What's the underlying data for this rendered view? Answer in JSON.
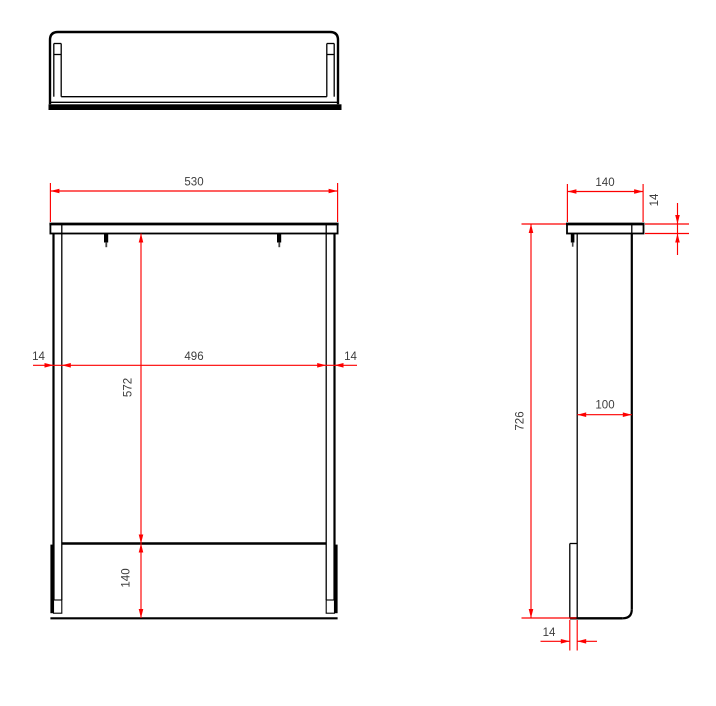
{
  "drawing": {
    "description": "Three-view technical drawing of a shelf unit with dimensions",
    "views": {
      "top": "top view",
      "front": "front view",
      "side": "side view"
    },
    "colors": {
      "outline": "#000000",
      "dimension_line": "#fd0000",
      "dimension_text": "#3d3d3d",
      "background": "#ffffff"
    }
  },
  "dimensions": {
    "front": {
      "overall_width": "530",
      "inner_width": "496",
      "left_panel_thickness": "14",
      "right_panel_thickness": "14",
      "opening_height": "572",
      "rail_height": "140"
    },
    "side": {
      "top_depth": "140",
      "top_thickness": "14",
      "overall_height": "726",
      "panel_depth": "100",
      "rail_thickness": "14"
    }
  }
}
